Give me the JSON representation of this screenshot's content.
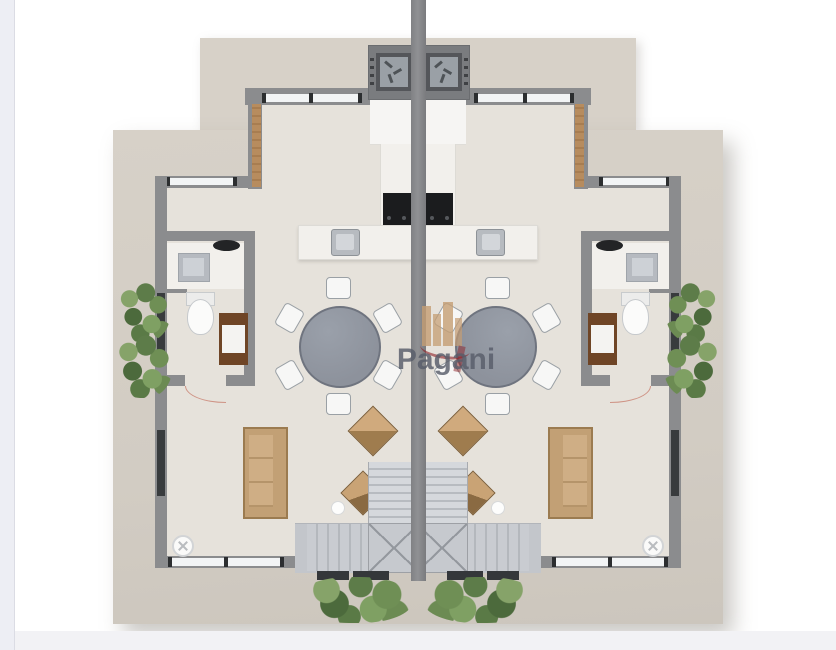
{
  "watermark": {
    "text": "Pagani"
  },
  "palette": {
    "canvas": "#ffffff",
    "page_edge": "#edeef4",
    "slab": "#d7d1c8",
    "floor": "#e6e2db",
    "wall": "#8b8c8e",
    "glass": "#f2f4f5",
    "glass_dark": "#383b3d",
    "wood": "#b78c5e",
    "marble": "#f2f0ec",
    "cooktop": "#1b1c1e",
    "sink_steel": "#b7bbc0",
    "table_gray": "#8d929c",
    "chair_white": "#f7f7f6",
    "sofa_tan": "#c2a075",
    "cabinet_brown": "#6f4526",
    "toilet_white": "#fbfbfa",
    "stair_gray": "#c7cbd0",
    "mat_dark": "#34373a",
    "plant_green": "#6a8a55",
    "logo_red": "#8e2127",
    "logo_tan": "#c49d73",
    "watermark_gray": "#585d6a"
  }
}
